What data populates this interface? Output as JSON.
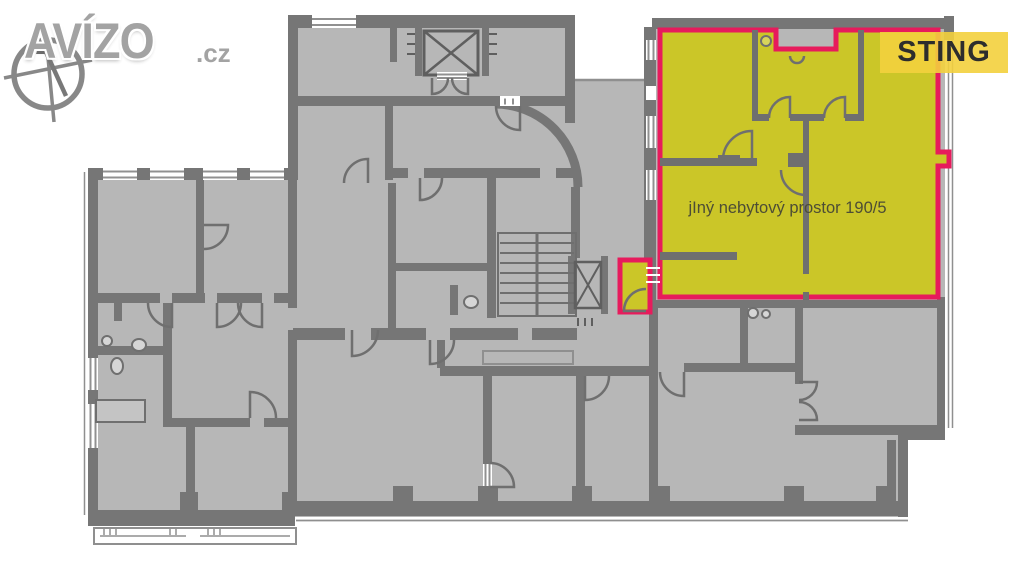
{
  "watermark": {
    "brand": "AVÍZO",
    "tld": ".cz"
  },
  "badge": {
    "label": "STING"
  },
  "plan": {
    "unit_label": "jIný nebytový prostor 190/5",
    "unit_fill_color": "#cbc628",
    "unit_outline_color": "#e71b5c",
    "wall_color": "#767676",
    "room_fill_color": "#b7b7b7",
    "background_color": "#ffffff"
  },
  "badge_style": {
    "background": "#f3d03d",
    "text_color": "#2d2d2d"
  }
}
